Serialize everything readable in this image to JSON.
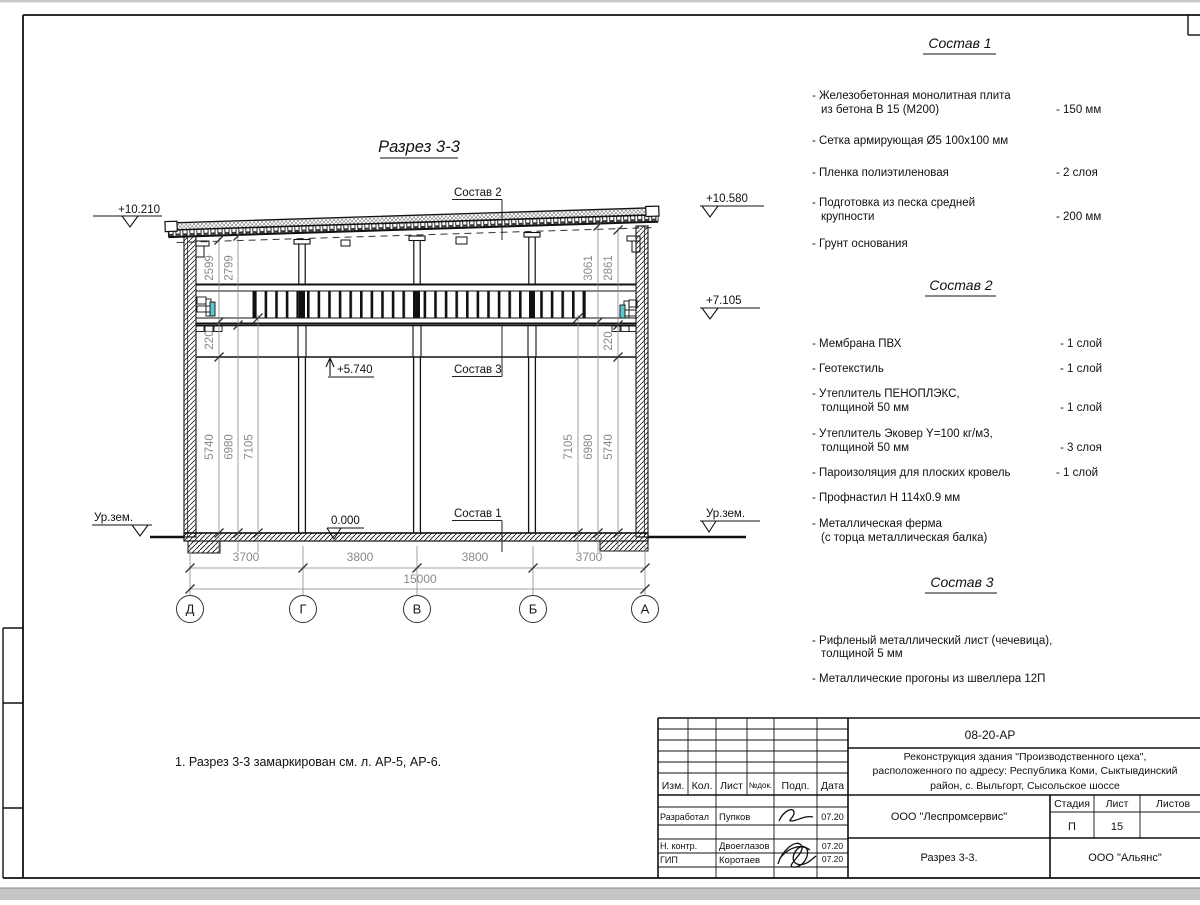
{
  "sheet": {
    "title": "Разрез 3-3",
    "note": "1. Разрез 3-3 замаркирован см. л. АР-5, АР-6."
  },
  "section": {
    "elevations": {
      "roof_left": "+10.210",
      "roof_right": "+10.580",
      "truss": "+7.105",
      "mezzanine": "+5.740",
      "floor": "0.000",
      "ground_left": "Ур.зем.",
      "ground_right": "Ур.зем."
    },
    "leaders": {
      "c1": "Состав 1",
      "c2": "Состав 2",
      "c3": "Состав 3"
    },
    "dims": {
      "spans": [
        "3700",
        "3800",
        "3800",
        "3700"
      ],
      "total": "15000",
      "left_top": [
        "2599",
        "2799"
      ],
      "right_top": [
        "3061",
        "2861"
      ],
      "left_side": [
        "220",
        "5740",
        "6980",
        "7105"
      ],
      "right_side": [
        "7105",
        "6980",
        "5740",
        "220"
      ],
      "axes": [
        "Д",
        "Г",
        "В",
        "Б",
        "А"
      ]
    }
  },
  "compositions": [
    {
      "title": "Состав 1",
      "items": [
        {
          "l1": "- Железобетонная  монолитная плита",
          "l2": "из бетона В 15 (М200)",
          "val": "- 150 мм"
        },
        {
          "l1": "- Сетка армирующая Ø5 100x100 мм",
          "l2": "",
          "val": ""
        },
        {
          "l1": "- Пленка полиэтиленовая",
          "l2": "",
          "val": "-  2 слоя"
        },
        {
          "l1": "- Подготовка из песка средней",
          "l2": "крупности",
          "val": "- 200 мм"
        },
        {
          "l1": "- Грунт основания",
          "l2": "",
          "val": ""
        }
      ]
    },
    {
      "title": "Состав 2",
      "items": [
        {
          "l1": "- Мембрана ПВХ",
          "l2": "",
          "val": "- 1 слой"
        },
        {
          "l1": "- Геотекстиль",
          "l2": "",
          "val": "- 1 слой"
        },
        {
          "l1": "- Утеплитель ПЕНОПЛЭКС,",
          "l2": "толщиной 50 мм",
          "val": "- 1 слой"
        },
        {
          "l1": "- Утеплитель Эковер Y=100 кг/м3,",
          "l2": "толщиной 50 мм",
          "val": "- 3 слоя"
        },
        {
          "l1": "- Пароизоляция для плоских кровель",
          "l2": "",
          "val": "- 1 слой"
        },
        {
          "l1": "- Профнастил Н 114x0.9 мм",
          "l2": "",
          "val": ""
        },
        {
          "l1": "- Металлическая ферма",
          "l2": "(с торца металлическая балка)",
          "val": ""
        }
      ]
    },
    {
      "title": "Состав 3",
      "items": [
        {
          "l1": "- Рифленый металлический лист (чечевица),",
          "l2": "толщиной 5 мм",
          "val": ""
        },
        {
          "l1": "- Металлические прогоны из швеллера 12П",
          "l2": "",
          "val": ""
        }
      ]
    }
  ],
  "title_block": {
    "doc_number": "08-20-АР",
    "project": [
      "Реконструкция здания \"Производственного цеха\",",
      "расположенного по адресу: Республика Коми, Сыктывдинский",
      "район, с. Выльгорт, Сысольское шоссе"
    ],
    "columns": [
      "Изм.",
      "Кол.",
      "Лист",
      "№док.",
      "Подп.",
      "Дата"
    ],
    "rows": [
      {
        "role": "Разработал",
        "name": "Пупков",
        "date": "07.20"
      },
      {
        "role": "Н. контр.",
        "name": "Двоеглазов",
        "date": "07.20"
      },
      {
        "role": "ГИП",
        "name": "Коротаев",
        "date": "07.20"
      }
    ],
    "org": "ООО \"Леспромсервис\"",
    "stage_label": "Стадия",
    "sheet_label": "Лист",
    "sheets_label": "Листов",
    "stage": "П",
    "sheet_no": "15",
    "drawing_name": "Разрез 3-3.",
    "contractor": "ООО \"Альянс\""
  }
}
